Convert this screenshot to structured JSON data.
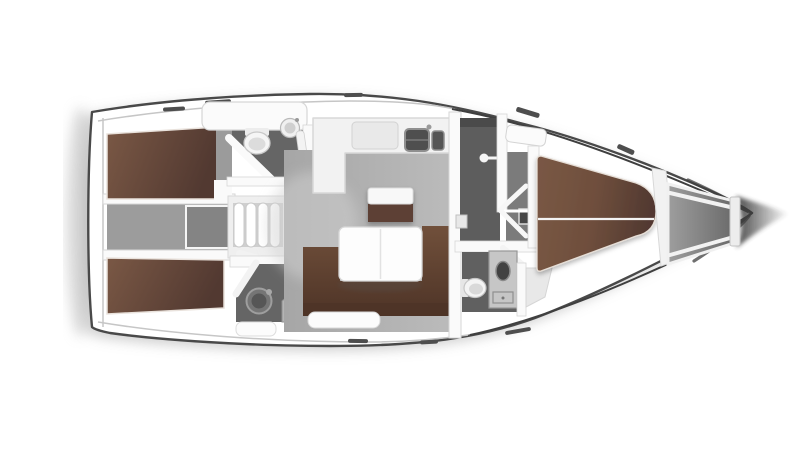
{
  "meta": {
    "title": "Sailing yacht interior floor plan, top view",
    "orientation": "bow-right"
  },
  "palette": {
    "background": "#ffffff",
    "hull_outline": "#4a4a4a",
    "hull_inner_line": "#c6c6c6",
    "sheer_dark": "#3f3f3f",
    "wall": "#fafafa",
    "wall_edge": "#d6d6d6",
    "deck_hatch": "#4e4e4e",
    "berth_brown": "#6e4e3c",
    "berth_brown_light": "#7a5845",
    "berth_brown_dark": "#523931",
    "sofa_brown": "#71503b",
    "sofa_brown_dark": "#4e3427",
    "sideboard_brown": "#5d4134",
    "table_white": "#fdfdfd",
    "floor_gray": "#a6a6a6",
    "floor_gray_light": "#bcbcbc",
    "engine_gray": "#9c9c9c",
    "engine_box_gray": "#848484",
    "head_floor": "#656565",
    "head_floor_dark": "#5d5d5d",
    "corridor_gray": "#7b7b7b",
    "locker_gray": "#9e9e9e",
    "locker_gray_dark": "#6a6a6a",
    "fixture_white": "#f5f5f5",
    "fixture_edge": "#c9c9c9",
    "sink_dark": "#4f4f4f",
    "steps_gap": "#cfcfcf",
    "shadow_gray": "#c2c2c2",
    "bow_cone": "#383838"
  },
  "rooms": {
    "aft_cabin_port": {
      "label": "Aft double cabin, port side"
    },
    "aft_cabin_starboard": {
      "label": "Aft double cabin, starboard side"
    },
    "aft_head_port": {
      "label": "Aft head with toilet and sink, port side"
    },
    "aft_head_starboard": {
      "label": "Aft head with toilet and vanity, starboard side"
    },
    "engine_compartment": {
      "label": "Engine compartment between aft cabins"
    },
    "companionway": {
      "label": "Companionway entry steps"
    },
    "galley": {
      "label": "L-shaped galley with twin sinks and stove"
    },
    "saloon": {
      "label": "Saloon with U-shaped sofa, folding table and sideboard"
    },
    "mid_head": {
      "label": "Mid head compartment with door handle"
    },
    "forward_corridor": {
      "label": "Corridor to forward cabin with open door"
    },
    "forward_head": {
      "label": "Forward head with toilet and vanity"
    },
    "forward_cabin": {
      "label": "Forward cabin with island double berth"
    },
    "anchor_locker": {
      "label": "Bow anchor locker with V-struts"
    }
  },
  "fixtures": {
    "toilet_aft_port": {
      "icon": "toilet-icon"
    },
    "sink_aft_port": {
      "icon": "sink-icon"
    },
    "toilet_aft_starboard": {
      "icon": "toilet-icon"
    },
    "vanity_aft_starboard": {
      "icon": "sink-icon"
    },
    "galley_sinks": {
      "icon": "double-sink-icon"
    },
    "galley_stove": {
      "icon": "stove-icon"
    },
    "steps": {
      "icon": "steps-icon"
    },
    "door_mid_head": {
      "icon": "door-handle-icon"
    },
    "door_forward_cabin": {
      "icon": "door-swing-icon"
    },
    "toilet_forward": {
      "icon": "toilet-icon"
    },
    "vanity_forward": {
      "icon": "sink-icon"
    },
    "saloon_table": {
      "icon": "table-icon"
    },
    "saloon_sofa": {
      "icon": "sofa-icon"
    },
    "berth_port": {
      "icon": "berth-icon"
    },
    "berth_starboard": {
      "icon": "berth-icon"
    },
    "berth_forward": {
      "icon": "berth-icon"
    }
  }
}
